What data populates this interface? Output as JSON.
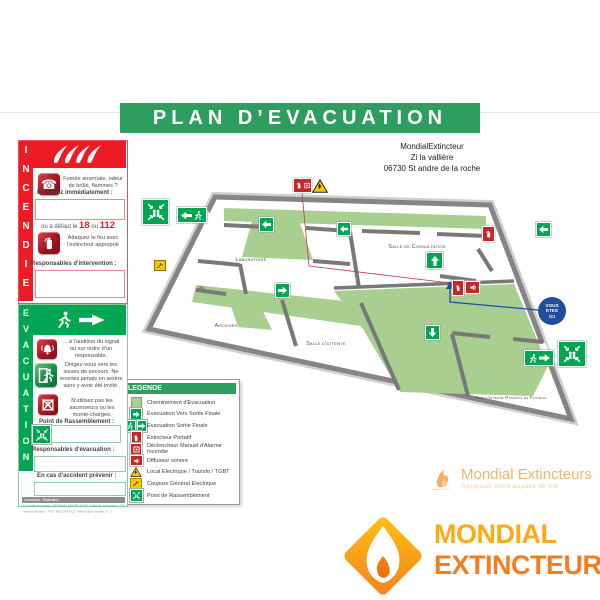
{
  "title_banner": "PLAN D’EVACUATION",
  "site": {
    "name": "MondialExtincteur",
    "address_line1": "Zi la vallière",
    "address_line2": "06730 St andre de la roche"
  },
  "incendie": {
    "vertical_label": "INCENDIE",
    "step_smoke_text": "Fumée anormale, odeur de brûlé, flammes ?",
    "notify_label": "Prévenez immédiatement :",
    "fallback_prefix": "ou à défaut le",
    "fallback_number1": "18",
    "fallback_or": "ou",
    "fallback_number2": "112",
    "attack_text": "Attaquez le feu avec l'extincteur approprié",
    "responsables_label": "Responsables d'intervention :"
  },
  "evacuation": {
    "vertical_label": "EVACUATION",
    "signal_text": "... à l'audition du signal ou sur ordre d'un responsable.",
    "exits_text": "Dirigez-vous vers les issues de secours. Ne revenez jamais en arrière sans y avoir été invité.",
    "lift_text": "N'utilisez pas les ascenseurs ou les monte-charges.",
    "assembly_label": "Point de Rassemblement :",
    "responsables_label": "Responsables d'évacuation :",
    "accident_label": "En cas d'accident prévenir :",
    "fine_print_bar": "Conception - Réalisation",
    "fine_print_line1": "Conception réalisée : MONDIAL EXTINCTEUR - Date de conception : 01/07/2014",
    "fine_print_line2": "numéro de plan : 75 07 665 5 04 3 C1 - Mise à jour du plan n° : 1"
  },
  "legend": {
    "title": "LEGENDE",
    "items": [
      {
        "icon": "evacuation-path-swatch",
        "label": "Cheminement d'Evacuation"
      },
      {
        "icon": "exit-arrow-icon",
        "label": "Evacuation Vers Sortie Finale"
      },
      {
        "icon": "exit-final-icon",
        "label": "Evacuation Sortie Finale"
      },
      {
        "icon": "extinguisher-icon",
        "label": "Extincteur Portatif"
      },
      {
        "icon": "manual-alarm-icon",
        "label": "Déclencheur Manuel d'Alarme Incendie"
      },
      {
        "icon": "sounder-icon",
        "label": "Diffuseur sonore"
      },
      {
        "icon": "electrical-warning-icon",
        "label": "Local Electrique / Transfo / TGBT"
      },
      {
        "icon": "power-cutoff-icon",
        "label": "Coupure Général Electrique"
      },
      {
        "icon": "assembly-point-icon",
        "label": "Point de Rassemblement"
      }
    ]
  },
  "plan": {
    "rooms": [
      "Laboratoire",
      "Wc",
      "Archives",
      "Salle d'attente",
      "Salle de Consultation",
      "Aire d'attente Patients en Fauteuil"
    ],
    "you_are_here": {
      "line1": "VOUS",
      "line2": "ETES",
      "line3": "ICI"
    }
  },
  "watermark": {
    "name": "Mondial Extincteurs",
    "tagline": "Sécuriser votre espace de vie"
  },
  "logo": {
    "word1": "MONDIAL",
    "word2": "EXTINCTEUR"
  },
  "colors": {
    "banner_green": "#2E9E60",
    "safety_green": "#00A651",
    "incendie_red": "#ED1C24",
    "path_green": "#A8CF90",
    "warning_yellow": "#F7C700",
    "you_are_here_blue": "#1E4E9C",
    "logo_yellow": "#FBAB18",
    "logo_orange": "#F47D1F"
  }
}
